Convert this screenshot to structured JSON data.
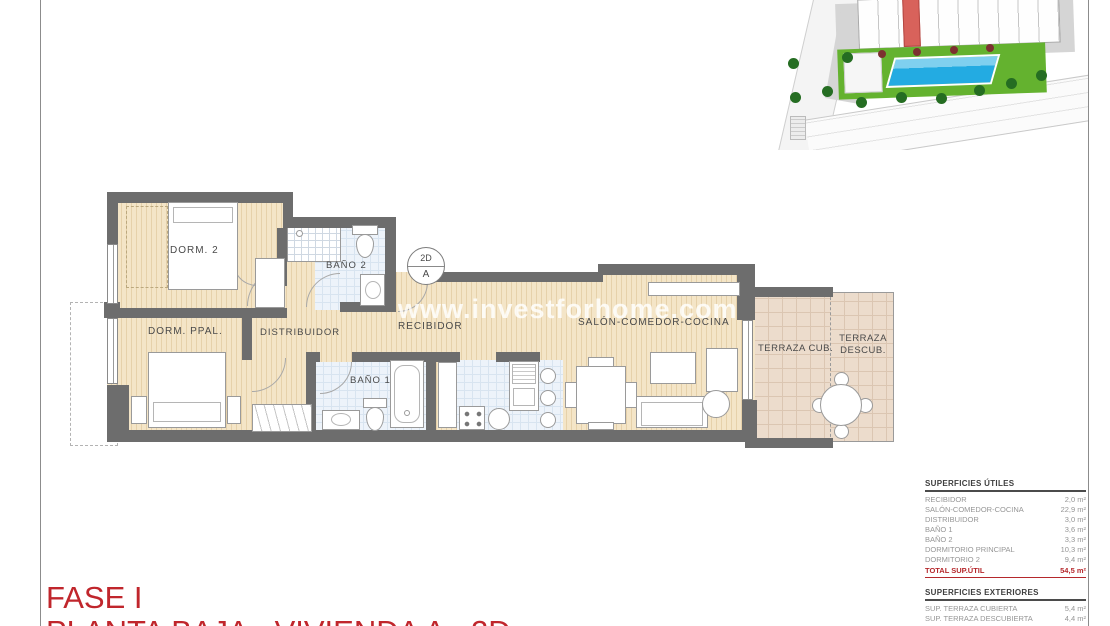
{
  "sheet": {
    "phase": "FASE I",
    "title": "PLANTA BAJA - VIVIENDA A - 2D"
  },
  "watermark": "www.investforhome.com",
  "badge": {
    "top": "2D",
    "bottom": "A"
  },
  "rooms": {
    "dorm2": "DORM. 2",
    "dorm_ppal": "DORM. PPAL.",
    "distribuidor": "DISTRIBUIDOR",
    "recibidor": "RECIBIDOR",
    "bano1": "BAÑO 1",
    "bano2": "BAÑO 2",
    "salon": "SALÓN-COMEDOR-COCINA",
    "terraza_cub": "TERRAZA CUB.",
    "terraza_descub": "TERRAZA DESCUB."
  },
  "areas_utiles": {
    "header": "SUPERFICIES ÚTILES",
    "rows": [
      {
        "label": "RECIBIDOR",
        "value": "2,0 m²"
      },
      {
        "label": "SALÓN-COMEDOR-COCINA",
        "value": "22,9 m²"
      },
      {
        "label": "DISTRIBUIDOR",
        "value": "3,0 m²"
      },
      {
        "label": "BAÑO 1",
        "value": "3,6 m²"
      },
      {
        "label": "BAÑO 2",
        "value": "3,3 m²"
      },
      {
        "label": "DORMITORIO PRINCIPAL",
        "value": "10,3 m²"
      },
      {
        "label": "DORMITORIO 2",
        "value": "9,4 m²"
      }
    ],
    "total_label": "TOTAL SUP.ÚTIL",
    "total_value": "54,5 m²"
  },
  "areas_exteriores": {
    "header": "SUPERFICIES EXTERIORES",
    "rows": [
      {
        "label": "SUP. TERRAZA CUBIERTA",
        "value": "5,4 m²"
      },
      {
        "label": "SUP. TERRAZA DESCUBIERTA",
        "value": "4,4 m²"
      }
    ],
    "total_label": "TOTAL SUP.CONST. + ZZ.CC.",
    "total_value": "80,30 m²"
  },
  "colors": {
    "accent_red": "#c0262c",
    "wall_gray": "#6d6d6d",
    "floor_beige": "#f4e5c7",
    "tile_blue": "#edf3fa",
    "terrace_pink": "#ecdccc",
    "pool_blue": "#23abe2",
    "garden_green": "#64b22f",
    "highlight_unit_red": "#d8625b"
  }
}
